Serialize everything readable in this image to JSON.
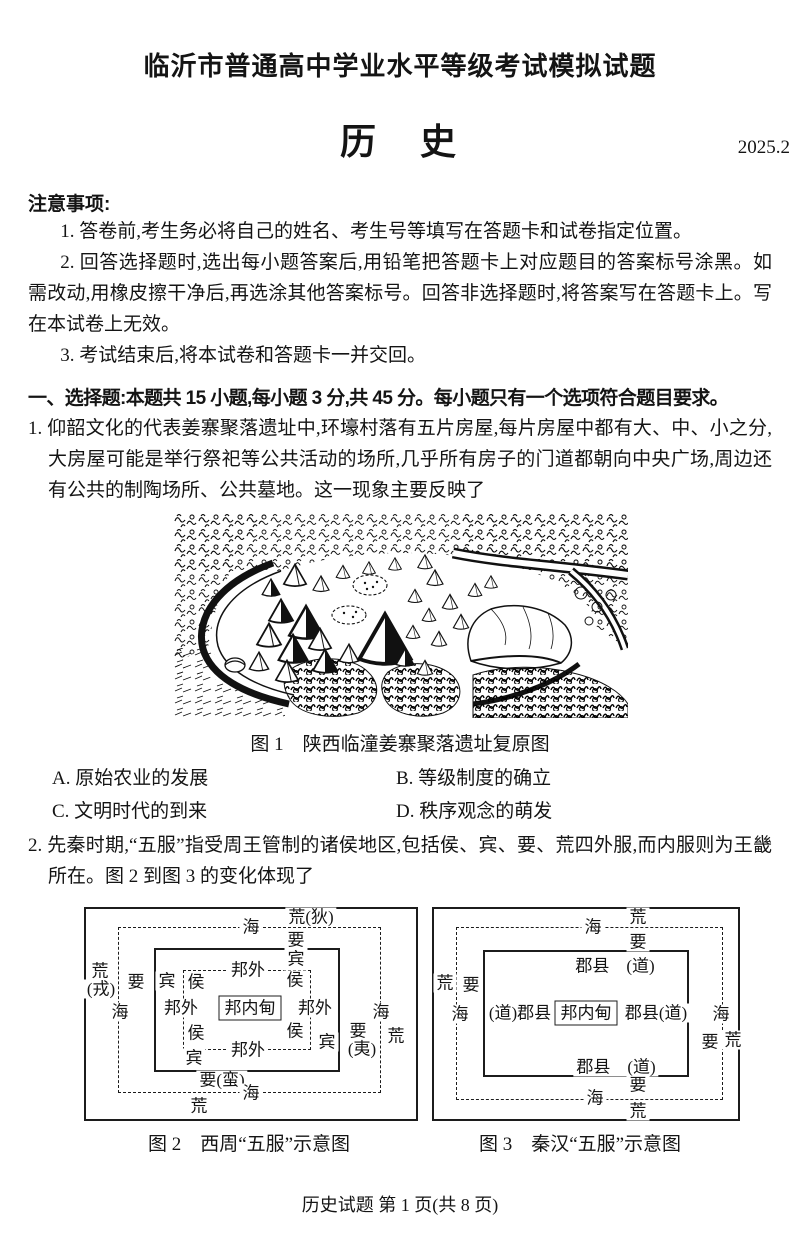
{
  "header": {
    "exam_title": "临沂市普通高中学业水平等级考试模拟试题",
    "subject": "历　史",
    "date": "2025.2"
  },
  "notice": {
    "heading": "注意事项:",
    "item1": "1. 答卷前,考生务必将自己的姓名、考生号等填写在答题卡和试卷指定位置。",
    "item2": "2. 回答选择题时,选出每小题答案后,用铅笔把答题卡上对应题目的答案标号涂黑。如需改动,用橡皮擦干净后,再选涂其他答案标号。回答非选择题时,将答案写在答题卡上。写在本试卷上无效。",
    "item3": "3. 考试结束后,将本试卷和答题卡一并交回。"
  },
  "section1": {
    "heading": "一、选择题:本题共 15 小题,每小题 3 分,共 45 分。每小题只有一个选项符合题目要求。"
  },
  "q1": {
    "text": "1. 仰韶文化的代表姜寨聚落遗址中,环壕村落有五片房屋,每片房屋中都有大、中、小之分,大房屋可能是举行祭祀等公共活动的场所,几乎所有房子的门道都朝向中央广场,周边还有公共的制陶场所、公共墓地。这一现象主要反映了",
    "figure_caption": "图 1　陕西临潼姜寨聚落遗址复原图",
    "options": {
      "a": "A. 原始农业的发展",
      "b": "B. 等级制度的确立",
      "c": "C. 文明时代的到来",
      "d": "D. 秩序观念的萌发"
    }
  },
  "q2": {
    "text": "2. 先秦时期,“五服”指受周王管制的诸侯地区,包括侯、宾、要、荒四外服,而内服则为王畿所在。图 2 到图 3 的变化体现了",
    "fig2": {
      "caption": "图 2　西周“五服”示意图",
      "labels": {
        "huang_di": "荒(狄)",
        "hai_top": "海",
        "yao_top": "要",
        "bin_top": "宾",
        "bangwai_top": "邦外",
        "hou_tl": "侯",
        "hou_tr": "侯",
        "bin_left": "宾",
        "yao_left": "要",
        "huang_left_1": "荒",
        "huang_left_2": "(戎)",
        "hai_left": "海",
        "bangwai_left": "邦外",
        "center": "邦内甸",
        "bangwai_right": "邦外",
        "hai_right": "海",
        "hou_bl": "侯",
        "hou_br": "侯",
        "bin_right": "宾",
        "yao_right_1": "要",
        "yao_right_2": "(夷)",
        "huang_right": "荒",
        "bangwai_bottom": "邦外",
        "bin_bottom": "宾",
        "yao_man": "要(蛮)",
        "hai_bottom": "海",
        "huang_bottom": "荒"
      }
    },
    "fig3": {
      "caption": "图 3　秦汉“五服”示意图",
      "labels": {
        "huang_top": "荒",
        "hai_top": "海",
        "yao_top": "要",
        "junxian_top": "郡县　(道)",
        "huang_left": "荒",
        "yao_left": "要",
        "hai_left": "海",
        "junxian_left": "(道)郡县",
        "center": "邦内甸",
        "junxian_right": "郡县(道)",
        "hai_right": "海",
        "yao_right": "要",
        "huang_right": "荒",
        "junxian_bottom": "郡县　(道)",
        "yao_bottom": "要",
        "hai_bottom": "海",
        "huang_bottom": "荒"
      }
    }
  },
  "footer": {
    "page_label": "历史试题 第 1 页(共 8 页)"
  }
}
